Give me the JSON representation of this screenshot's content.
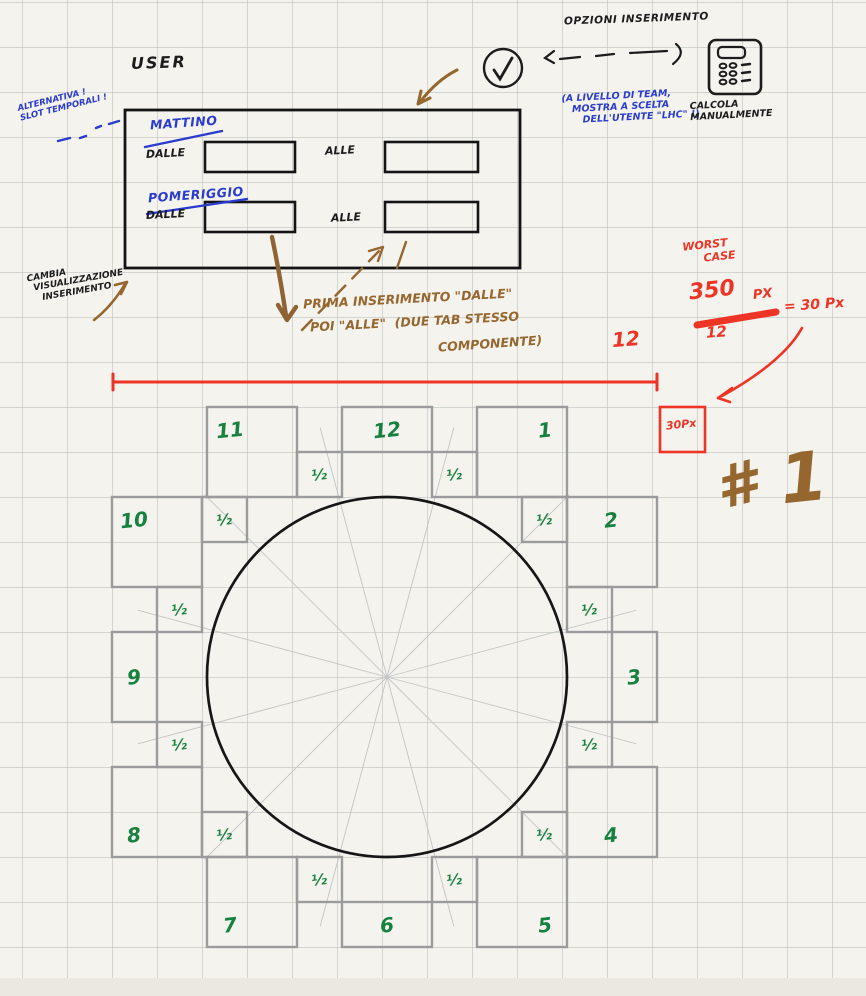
{
  "palette": {
    "ink_black": "#1c1c1c",
    "ink_blue": "#2a3bcf",
    "ink_brown": "#96662f",
    "ink_red": "#ee3425",
    "ink_green": "#17813f",
    "box_gray": "#9b9b9b",
    "grid": "#d9dcd6",
    "paper": "#f4f3ee"
  },
  "top": {
    "opzioni": "OPZIONI INSERIMENTO",
    "team_note": {
      "l1": "(A LIVELLO DI TEAM,",
      "l2": "MOSTRA A SCELTA",
      "l3": "DELL'UTENTE \"LHC\" !)"
    },
    "calcola": {
      "l1": "CALCOLA",
      "l2": "MANUALMENTE"
    },
    "alternativa": {
      "l1": "ALTERNATIVA !",
      "l2": "SLOT TEMPORALI !"
    }
  },
  "user_panel": {
    "title": "USER",
    "mattino": "MATTINO",
    "pomeriggio": "POMERIGGIO",
    "dalle1": "DALLE",
    "alle1": "ALLE",
    "dalle2": "DALLE",
    "alle2": "ALLE"
  },
  "notes": {
    "cambia": {
      "l1": "CAMBIA",
      "l2": "VISUALIZZAZIONE",
      "l3": "INSERIMENTO"
    },
    "prima": {
      "l1": "PRIMA INSERIMENTO \"DALLE\"",
      "l2": "POI \"ALLE\"  (DUE TAB STESSO",
      "l3": "COMPONENTE)"
    },
    "twelve": "12",
    "worst": {
      "l1": "WORST",
      "l2": "CASE"
    },
    "fraction": {
      "num": "350",
      "unit": "PX",
      "den": "12",
      "result": "= 30 Px"
    },
    "px_box": "30Px",
    "hash": {
      "sym": "#",
      "num": "1"
    }
  },
  "clock": {
    "center": {
      "x": 387,
      "y": 677
    },
    "radius": 180,
    "spoke_len": 258,
    "half_label": "½",
    "hours": [
      {
        "label": "12",
        "x": 342,
        "y": 407,
        "w": 90,
        "h": 45,
        "lx": 387,
        "ly": 430
      },
      {
        "label": "1",
        "x": 477,
        "y": 407,
        "w": 90,
        "h": 90,
        "lx": 545,
        "ly": 430
      },
      {
        "label": "2",
        "x": 567,
        "y": 497,
        "w": 90,
        "h": 90,
        "lx": 611,
        "ly": 520
      },
      {
        "label": "3",
        "x": 612,
        "y": 632,
        "w": 45,
        "h": 90,
        "lx": 634,
        "ly": 677
      },
      {
        "label": "4",
        "x": 567,
        "y": 767,
        "w": 90,
        "h": 90,
        "lx": 611,
        "ly": 835
      },
      {
        "label": "5",
        "x": 477,
        "y": 857,
        "w": 90,
        "h": 90,
        "lx": 545,
        "ly": 925
      },
      {
        "label": "6",
        "x": 342,
        "y": 902,
        "w": 90,
        "h": 45,
        "lx": 387,
        "ly": 925
      },
      {
        "label": "7",
        "x": 207,
        "y": 857,
        "w": 90,
        "h": 90,
        "lx": 230,
        "ly": 925
      },
      {
        "label": "8",
        "x": 112,
        "y": 767,
        "w": 90,
        "h": 90,
        "lx": 134,
        "ly": 835
      },
      {
        "label": "9",
        "x": 112,
        "y": 632,
        "w": 45,
        "h": 90,
        "lx": 134,
        "ly": 677
      },
      {
        "label": "10",
        "x": 112,
        "y": 497,
        "w": 90,
        "h": 90,
        "lx": 134,
        "ly": 520
      },
      {
        "label": "11",
        "x": 207,
        "y": 407,
        "w": 90,
        "h": 90,
        "lx": 230,
        "ly": 430
      }
    ],
    "halves": [
      {
        "x": 432,
        "y": 452
      },
      {
        "x": 522,
        "y": 497
      },
      {
        "x": 567,
        "y": 587
      },
      {
        "x": 567,
        "y": 722
      },
      {
        "x": 522,
        "y": 812
      },
      {
        "x": 432,
        "y": 857
      },
      {
        "x": 297,
        "y": 857
      },
      {
        "x": 202,
        "y": 812
      },
      {
        "x": 157,
        "y": 722
      },
      {
        "x": 157,
        "y": 587
      },
      {
        "x": 202,
        "y": 497
      },
      {
        "x": 297,
        "y": 452
      }
    ]
  }
}
